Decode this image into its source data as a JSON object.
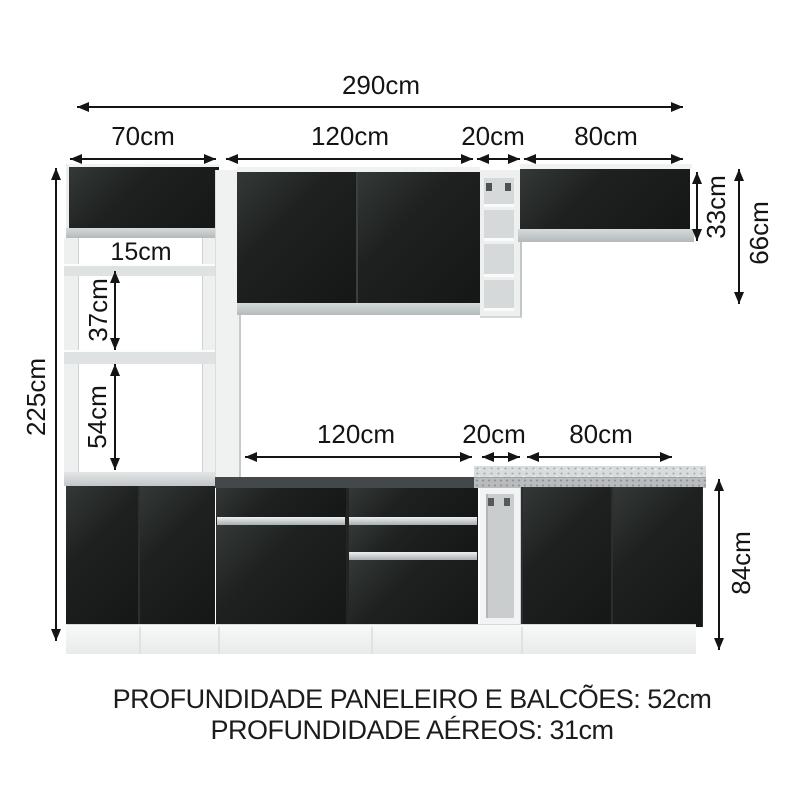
{
  "diagram": {
    "total_width_label": "290cm",
    "top_row": {
      "pantry_width": "70cm",
      "wall_cabinet_width": "120cm",
      "open_shelf_width": "20cm",
      "right_wall_cabinet_width": "80cm"
    },
    "middle_row": {
      "base_cabinet_width": "120cm",
      "open_base_width": "20cm",
      "right_base_cabinet_width": "80cm"
    },
    "left_total_height": "225cm",
    "pantry_niche_height": "15cm",
    "pantry_upper_gap": "37cm",
    "pantry_lower_gap": "54cm",
    "wall_cabinet_height": "33cm",
    "upper_section_height": "66cm",
    "base_cabinet_height": "84cm"
  },
  "footer": {
    "line1": "PROFUNDIDADE PANELEIRO E BALCÕES: 52cm",
    "line2": "PROFUNDIDADE AÉREOS: 31cm"
  },
  "colors": {
    "door_black": "#1d201f",
    "carcass_white": "#eef0f0",
    "trim_band": "#c9cdcf",
    "handle_silver": "#cdd2d4",
    "dimension_line": "#141414"
  }
}
